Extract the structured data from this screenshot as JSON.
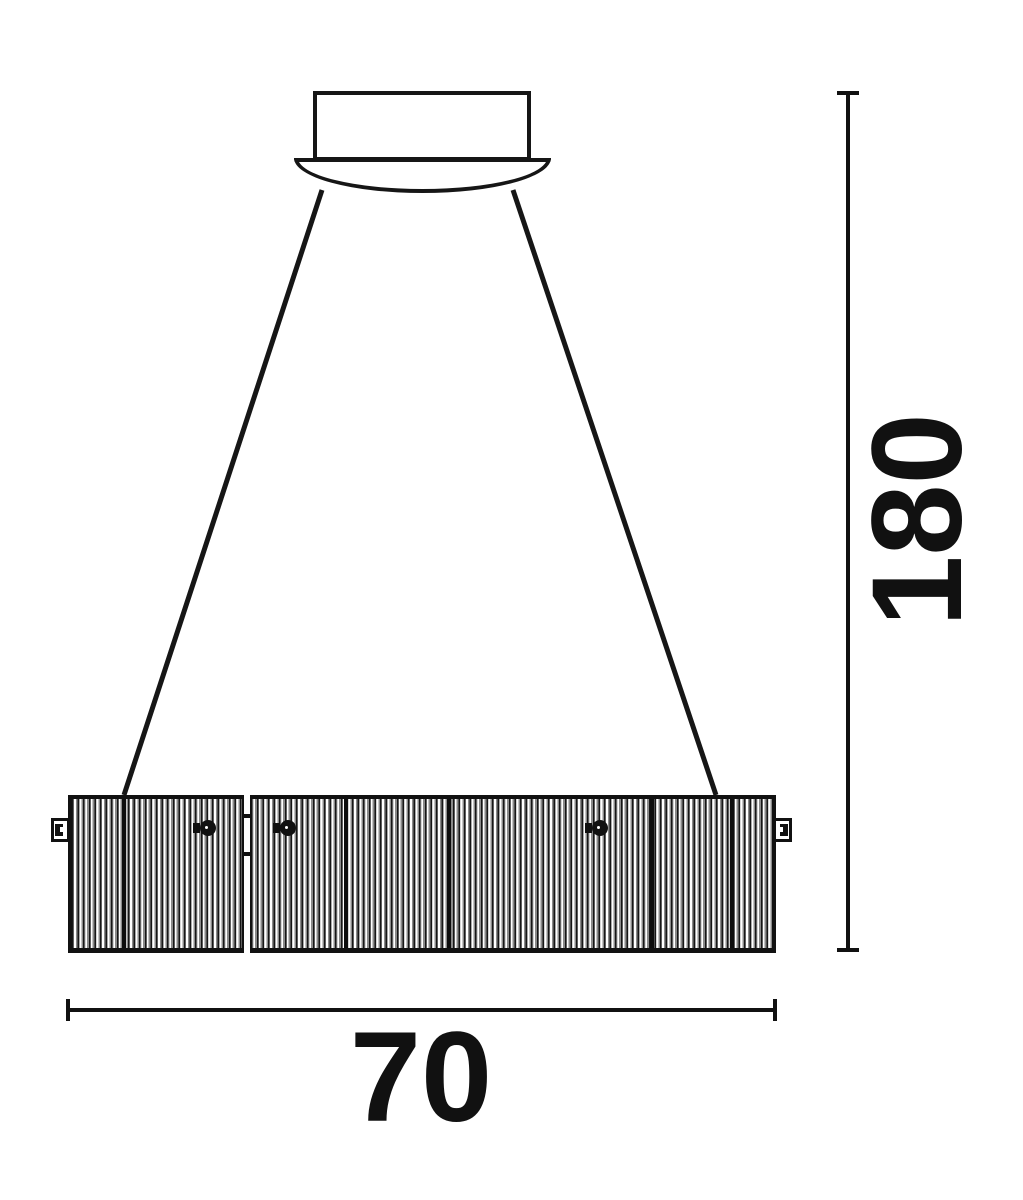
{
  "diagram": {
    "line_color": "#161616",
    "background_color": "#ffffff",
    "parts": {
      "canopy": "ceiling-canopy",
      "wires": "suspension-wires",
      "shade": "striped-drum-shade"
    }
  },
  "dimensions": {
    "height_label": "180",
    "width_label": "70"
  }
}
